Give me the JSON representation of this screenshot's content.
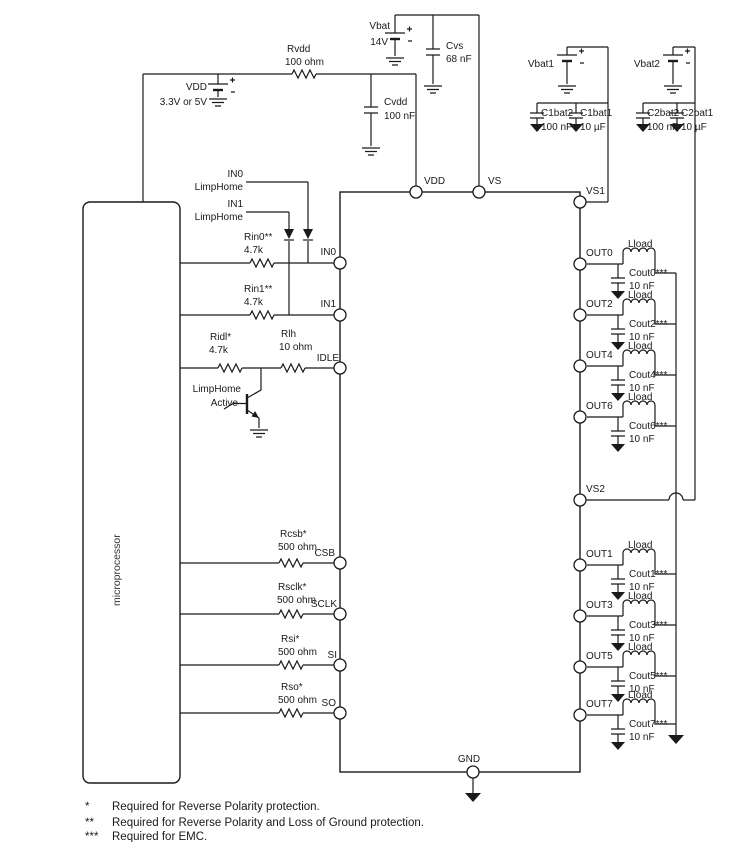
{
  "micro": {
    "label": "microprocessor"
  },
  "supplies": {
    "vdd": {
      "name": "VDD",
      "value": "3.3V or 5V"
    },
    "vbat": {
      "name": "Vbat",
      "value": "14V"
    },
    "vbat1": {
      "name": "Vbat1"
    },
    "vbat2": {
      "name": "Vbat2"
    }
  },
  "passives": {
    "rvdd": {
      "name": "Rvdd",
      "value": "100 ohm"
    },
    "cvdd": {
      "name": "Cvdd",
      "value": "100 nF"
    },
    "cvs": {
      "name": "Cvs",
      "value": "68 nF"
    },
    "c1bat2": {
      "name": "C1bat2",
      "value": "100 nF"
    },
    "c1bat1": {
      "name": "C1bat1",
      "value": "10 µF"
    },
    "c2bat2": {
      "name": "C2bat2",
      "value": "100 nF"
    },
    "c2bat1": {
      "name": "C2bat1",
      "value": "10 µF"
    },
    "rin0": {
      "name": "Rin0**",
      "value": "4.7k"
    },
    "rin1": {
      "name": "Rin1**",
      "value": "4.7k"
    },
    "ridl": {
      "name": "Ridl*",
      "value": "4.7k"
    },
    "rlh": {
      "name": "Rlh",
      "value": "10 ohm"
    },
    "rcsb": {
      "name": "Rcsb*",
      "value": "500 ohm"
    },
    "rsclk": {
      "name": "Rsclk*",
      "value": "500 ohm"
    },
    "rsi": {
      "name": "Rsi*",
      "value": "500 ohm"
    },
    "rso": {
      "name": "Rso*",
      "value": "500 ohm"
    }
  },
  "signals": {
    "in0_limphome": {
      "line1": "IN0",
      "line2": "LimpHome"
    },
    "in1_limphome": {
      "line1": "IN1",
      "line2": "LimpHome"
    },
    "limphome_active": {
      "line1": "LimpHome",
      "line2": "Active"
    }
  },
  "ic": {
    "pins": {
      "vdd": "VDD",
      "vs": "VS",
      "vs1": "VS1",
      "vs2": "VS2",
      "gnd": "GND",
      "in0": "IN0",
      "in1": "IN1",
      "idle": "IDLE",
      "csb": "CSB",
      "sclk": "SCLK",
      "si": "SI",
      "so": "SO"
    }
  },
  "outputs_top": [
    {
      "pin": "OUT0",
      "load": "Lload",
      "cap": "Cout0***",
      "cap_value": "10 nF"
    },
    {
      "pin": "OUT2",
      "load": "Lload",
      "cap": "Cout2***",
      "cap_value": "10 nF"
    },
    {
      "pin": "OUT4",
      "load": "Lload",
      "cap": "Cout4***",
      "cap_value": "10 nF"
    },
    {
      "pin": "OUT6",
      "load": "Lload",
      "cap": "Cout6***",
      "cap_value": "10 nF"
    }
  ],
  "outputs_bottom": [
    {
      "pin": "OUT1",
      "load": "Lload",
      "cap": "Cout1***",
      "cap_value": "10 nF"
    },
    {
      "pin": "OUT3",
      "load": "Lload",
      "cap": "Cout3***",
      "cap_value": "10 nF"
    },
    {
      "pin": "OUT5",
      "load": "Lload",
      "cap": "Cout5***",
      "cap_value": "10 nF"
    },
    {
      "pin": "OUT7",
      "load": "Lload",
      "cap": "Cout7***",
      "cap_value": "10 nF"
    }
  ],
  "footnotes": [
    {
      "marker": "*",
      "text": "Required for Reverse Polarity protection."
    },
    {
      "marker": "**",
      "text": "Required for Reverse Polarity and Loss of Ground protection."
    },
    {
      "marker": "***",
      "text": "Required for EMC."
    }
  ]
}
